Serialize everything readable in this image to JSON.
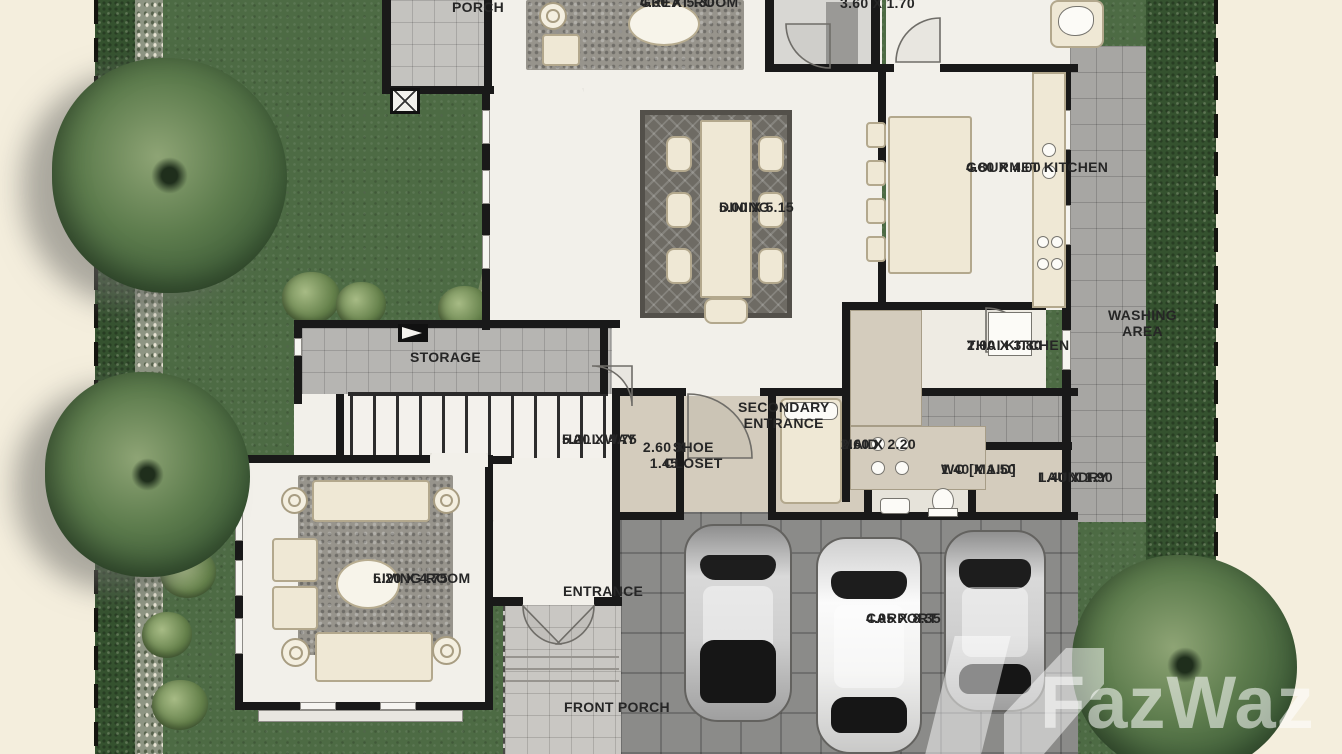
{
  "title": "House floor plan (1st floor)",
  "watermark": {
    "brand": "FazWaz"
  },
  "rooms": [
    {
      "id": "porch",
      "name": "PORCH",
      "dims": ""
    },
    {
      "id": "great-room",
      "name": "GREAT ROOM",
      "dims": "4.30 X 5.30"
    },
    {
      "id": "top-utility-room",
      "name": "",
      "dims": "3.60 X 1.70"
    },
    {
      "id": "gourmet-kitchen",
      "name": "GOURMET KITCHEN",
      "dims": "4.80 X 4.00"
    },
    {
      "id": "dining",
      "name": "DINING",
      "dims": "5.00 X 5.15"
    },
    {
      "id": "washing-area",
      "name": "WASHING AREA",
      "dims": ""
    },
    {
      "id": "thai-kitchen",
      "name": "THAI KITCHEN",
      "dims": "2.00 X 3.80"
    },
    {
      "id": "storage",
      "name": "STORAGE",
      "dims": ""
    },
    {
      "id": "hall-way",
      "name": "HALL WAY",
      "dims": "5.20 X 4.75"
    },
    {
      "id": "secondary-entrance",
      "name": "SECONDARY ENTRANCE",
      "dims": ""
    },
    {
      "id": "shoe-closet",
      "name": "SHOE CLOSET",
      "dims": "2.60 X 1.45"
    },
    {
      "id": "maid",
      "name": "MAID",
      "dims": "2.60 X 2.20"
    },
    {
      "id": "wc-maid",
      "name": "WC [MAID]",
      "dims": "1.40 X 1.50"
    },
    {
      "id": "laundry",
      "name": "LAUNDRY",
      "dims": "1.40 X 1.90"
    },
    {
      "id": "living-room",
      "name": "LIVING ROOM",
      "dims": "5.20 X 4.75"
    },
    {
      "id": "entrance",
      "name": "ENTRANCE",
      "dims": ""
    },
    {
      "id": "front-porch",
      "name": "FRONT PORCH",
      "dims": ""
    },
    {
      "id": "carport",
      "name": "CARPORT",
      "dims": "4.95 X 8.35"
    }
  ],
  "colors": {
    "background_cream": "#f4eedd",
    "lawn_green": "#4d6b44",
    "hedge_green": "#35522f",
    "wall_black": "#191919",
    "tile_gray": "#c4c3bf",
    "carport_gray": "#8b8b89",
    "counter_tan": "#d4ccbd",
    "furniture_cream": "#efe8d5",
    "rug_gray": "#97948c",
    "label_text": "#262626"
  }
}
